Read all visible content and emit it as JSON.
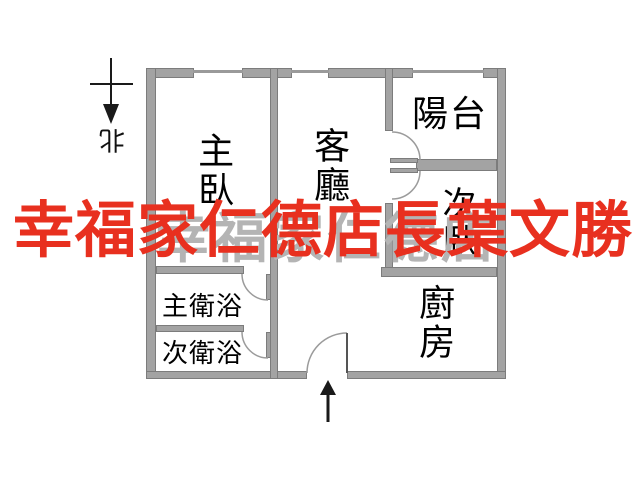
{
  "image_type": "floor-plan",
  "watermark": {
    "red_text": "幸福家仁德店長葉文勝",
    "red_color": "#e8301f",
    "gray_text": "幸福家仁德店",
    "gray_color": "#b4b4b4"
  },
  "compass": {
    "north_label": "北"
  },
  "rooms": {
    "master_bedroom": "主臥",
    "living_room": "客廳",
    "balcony": "陽台",
    "second_bedroom": "次臥",
    "kitchen": "廚房",
    "master_bathroom": "主衛浴",
    "second_bathroom": "次衛浴"
  },
  "colors": {
    "wall": "#a3a3a3",
    "wall_edge": "#7c7c7c",
    "background": "#ffffff",
    "label_text": "#000000"
  }
}
